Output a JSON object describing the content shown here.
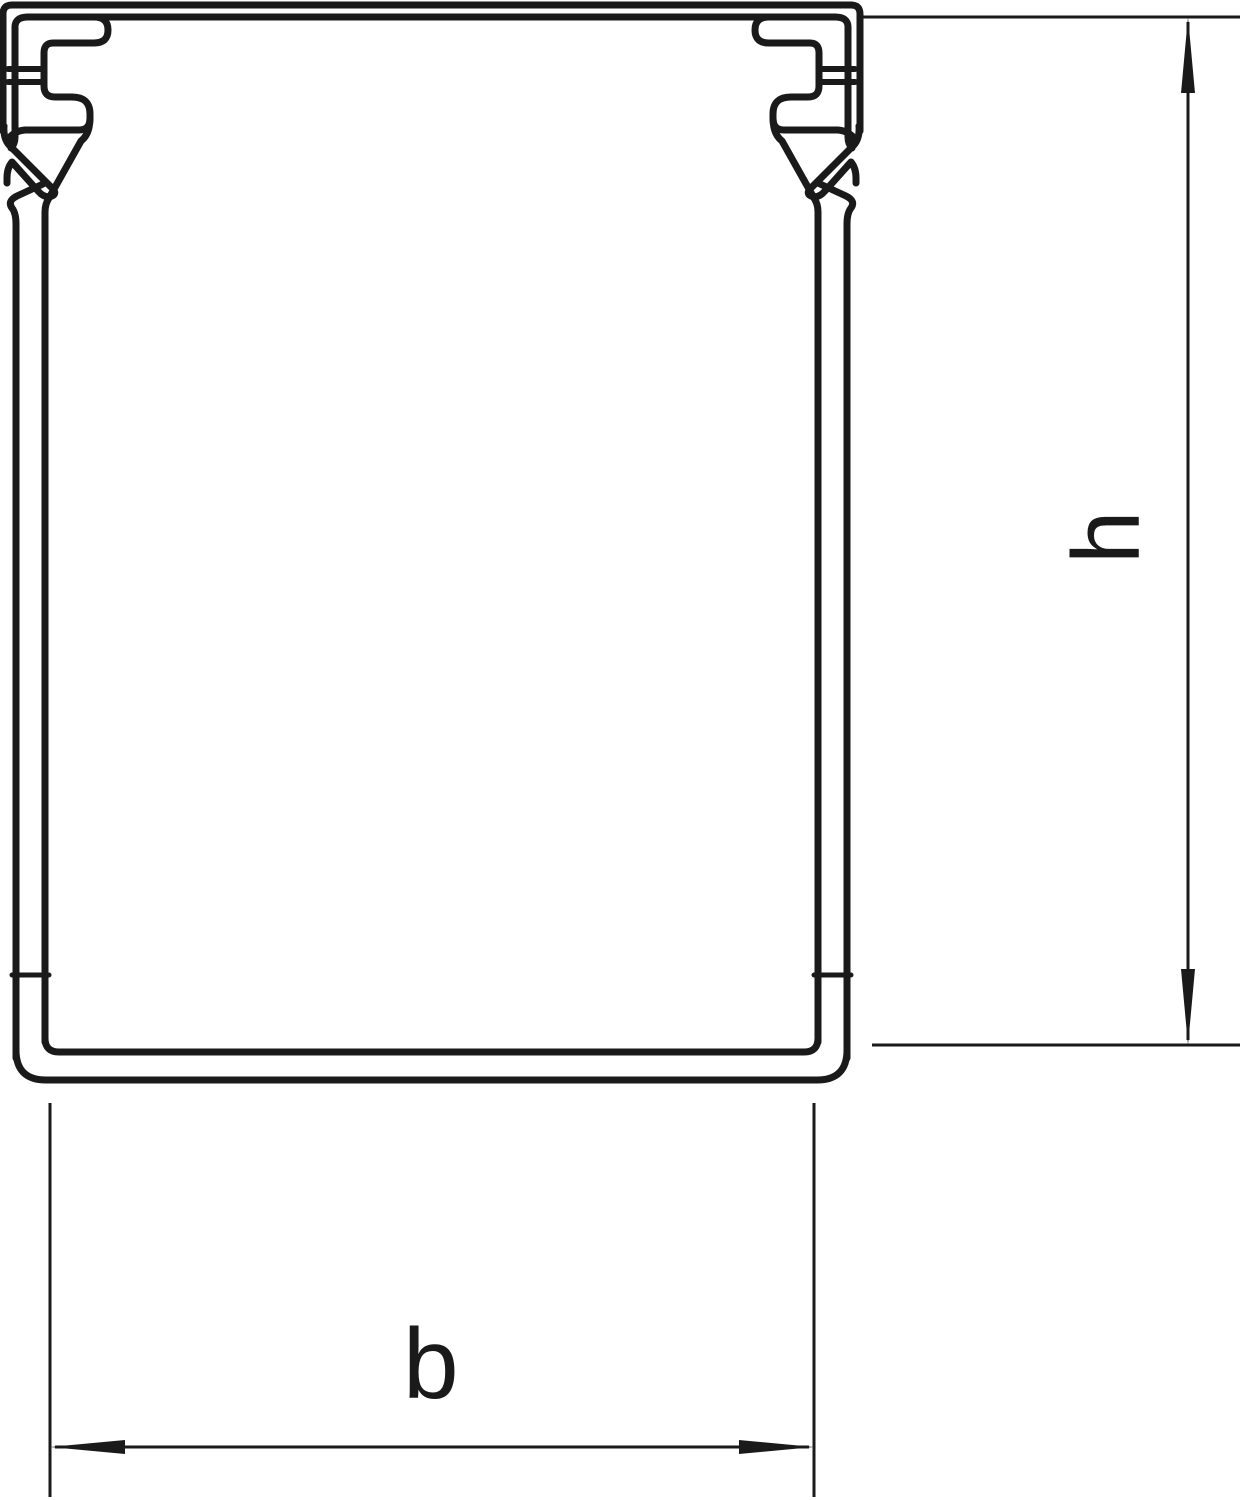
{
  "page": {
    "background": "#ffffff"
  },
  "drawing": {
    "type": "cable-duct-cross-section",
    "line_color": "#1a1a1a",
    "labels": {
      "height": "h",
      "width": "b"
    }
  }
}
